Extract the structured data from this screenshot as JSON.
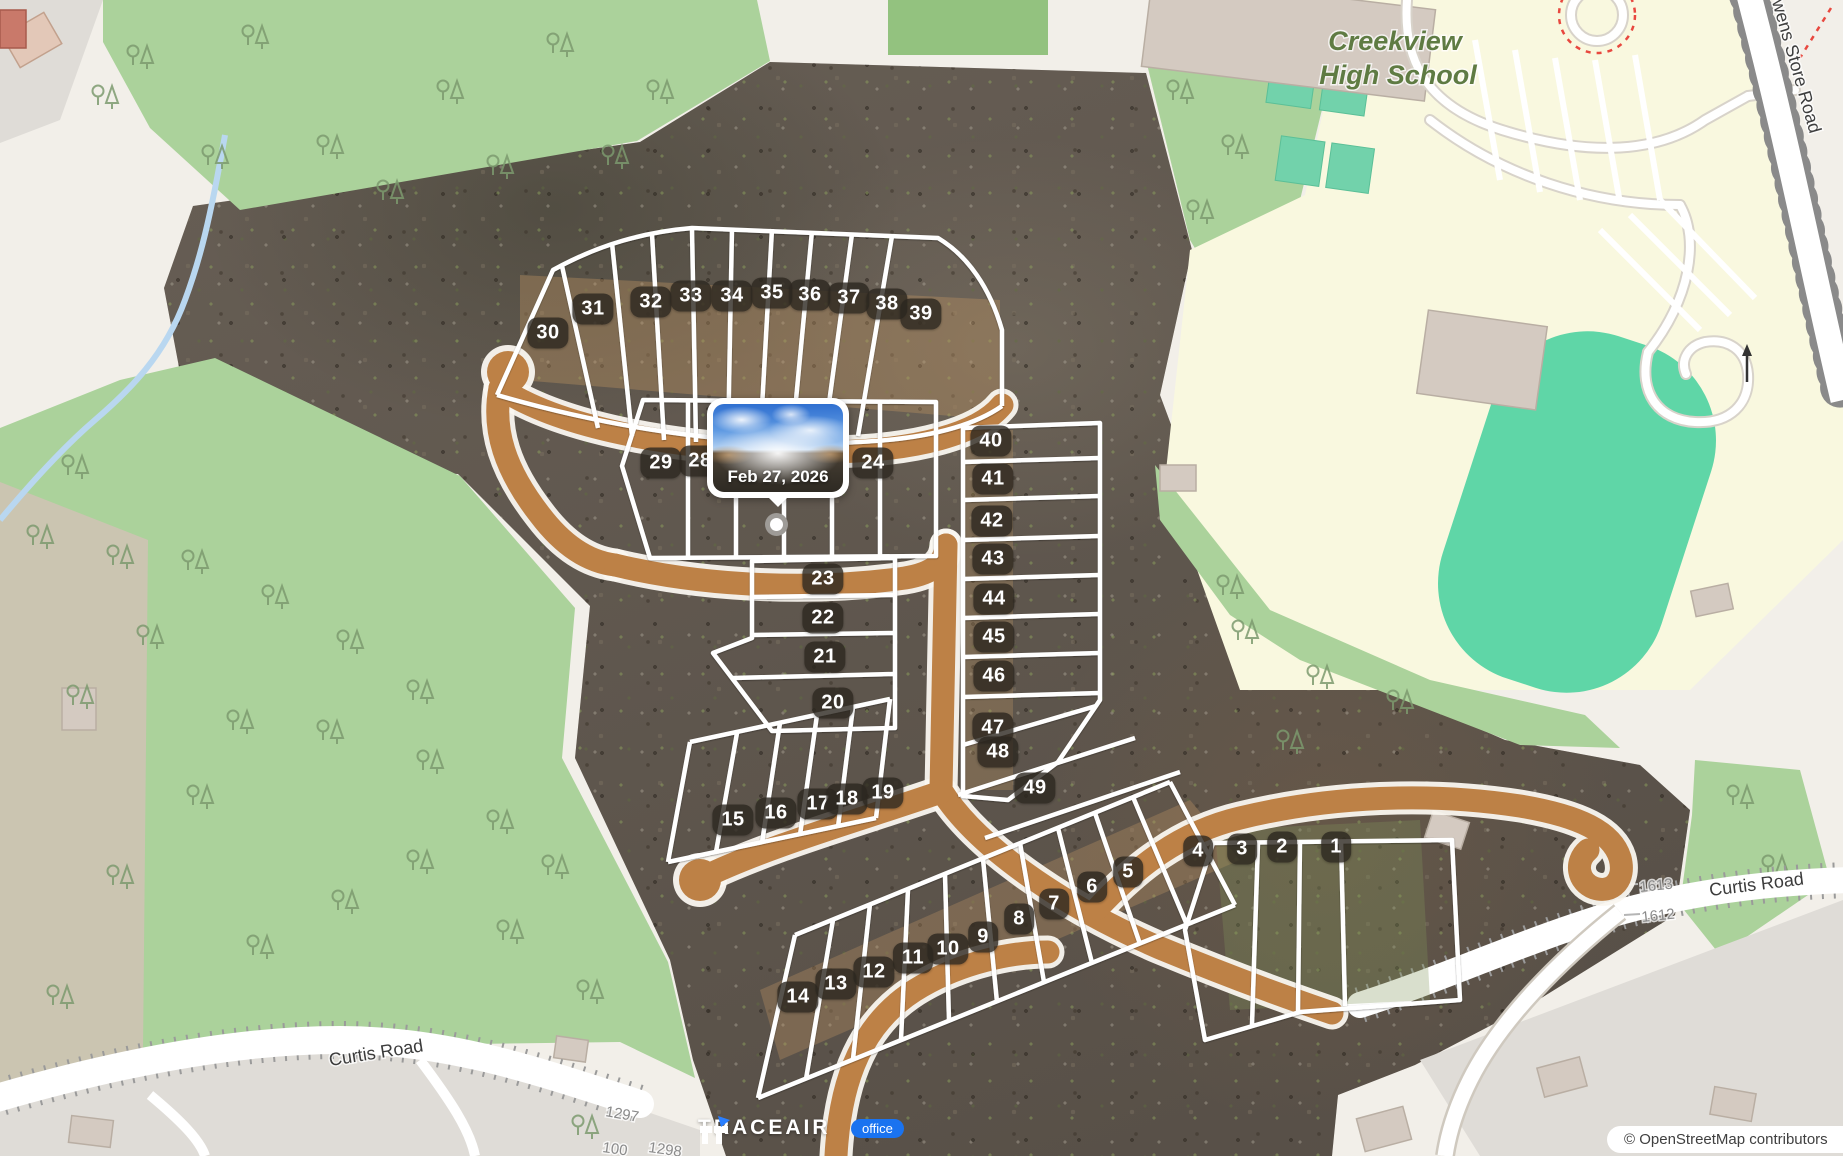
{
  "colors": {
    "badge_bg": "#2c271f",
    "office_blue": "#1a73f0",
    "forest_green": "#abd29b",
    "school_yellow": "#f9f8df",
    "pitch_teal": "#5fd6a7",
    "dirt_road_tan": "#bd8146",
    "lot_line_white": "#ffffff",
    "popup_white": "#ffffff"
  },
  "map": {
    "school_name_line1": "Creekview",
    "school_name_line2": "High School",
    "owens_store_road": "Owens Store Road",
    "curtis_road_left": "Curtis Road",
    "curtis_road_right": "Curtis Road",
    "house_numbers": {
      "left": [
        "1297",
        "100",
        "1298"
      ],
      "right": [
        "1613",
        "1612"
      ]
    }
  },
  "site": {
    "lots": [
      {
        "n": "1",
        "x": 1336,
        "y": 847
      },
      {
        "n": "2",
        "x": 1282,
        "y": 847
      },
      {
        "n": "3",
        "x": 1242,
        "y": 849
      },
      {
        "n": "4",
        "x": 1198,
        "y": 851
      },
      {
        "n": "5",
        "x": 1128,
        "y": 872
      },
      {
        "n": "6",
        "x": 1092,
        "y": 887
      },
      {
        "n": "7",
        "x": 1054,
        "y": 904
      },
      {
        "n": "8",
        "x": 1019,
        "y": 919
      },
      {
        "n": "9",
        "x": 983,
        "y": 937
      },
      {
        "n": "10",
        "x": 948,
        "y": 949
      },
      {
        "n": "11",
        "x": 913,
        "y": 958
      },
      {
        "n": "12",
        "x": 874,
        "y": 972
      },
      {
        "n": "13",
        "x": 836,
        "y": 984
      },
      {
        "n": "14",
        "x": 798,
        "y": 997
      },
      {
        "n": "15",
        "x": 733,
        "y": 820
      },
      {
        "n": "16",
        "x": 776,
        "y": 813
      },
      {
        "n": "17",
        "x": 818,
        "y": 804
      },
      {
        "n": "18",
        "x": 847,
        "y": 799
      },
      {
        "n": "19",
        "x": 883,
        "y": 793
      },
      {
        "n": "20",
        "x": 833,
        "y": 703
      },
      {
        "n": "21",
        "x": 825,
        "y": 657
      },
      {
        "n": "22",
        "x": 823,
        "y": 618
      },
      {
        "n": "23",
        "x": 823,
        "y": 579
      },
      {
        "n": "24",
        "x": 873,
        "y": 463
      },
      {
        "n": "28",
        "x": 700,
        "y": 461
      },
      {
        "n": "29",
        "x": 661,
        "y": 463
      },
      {
        "n": "30",
        "x": 548,
        "y": 333
      },
      {
        "n": "31",
        "x": 593,
        "y": 309
      },
      {
        "n": "32",
        "x": 651,
        "y": 302
      },
      {
        "n": "33",
        "x": 691,
        "y": 296
      },
      {
        "n": "34",
        "x": 732,
        "y": 296
      },
      {
        "n": "35",
        "x": 772,
        "y": 293
      },
      {
        "n": "36",
        "x": 810,
        "y": 295
      },
      {
        "n": "37",
        "x": 849,
        "y": 298
      },
      {
        "n": "38",
        "x": 887,
        "y": 304
      },
      {
        "n": "39",
        "x": 921,
        "y": 314
      },
      {
        "n": "40",
        "x": 991,
        "y": 441
      },
      {
        "n": "41",
        "x": 993,
        "y": 479
      },
      {
        "n": "42",
        "x": 992,
        "y": 521
      },
      {
        "n": "43",
        "x": 993,
        "y": 559
      },
      {
        "n": "44",
        "x": 994,
        "y": 599
      },
      {
        "n": "45",
        "x": 994,
        "y": 637
      },
      {
        "n": "46",
        "x": 994,
        "y": 676
      },
      {
        "n": "47",
        "x": 993,
        "y": 728
      },
      {
        "n": "48",
        "x": 998,
        "y": 752
      },
      {
        "n": "49",
        "x": 1035,
        "y": 788
      }
    ]
  },
  "popup": {
    "date": "Feb 27, 2026"
  },
  "branding": {
    "logo_text": "TRACEAIR",
    "office_label": "office"
  },
  "attribution": {
    "text": "© OpenStreetMap contributors"
  }
}
